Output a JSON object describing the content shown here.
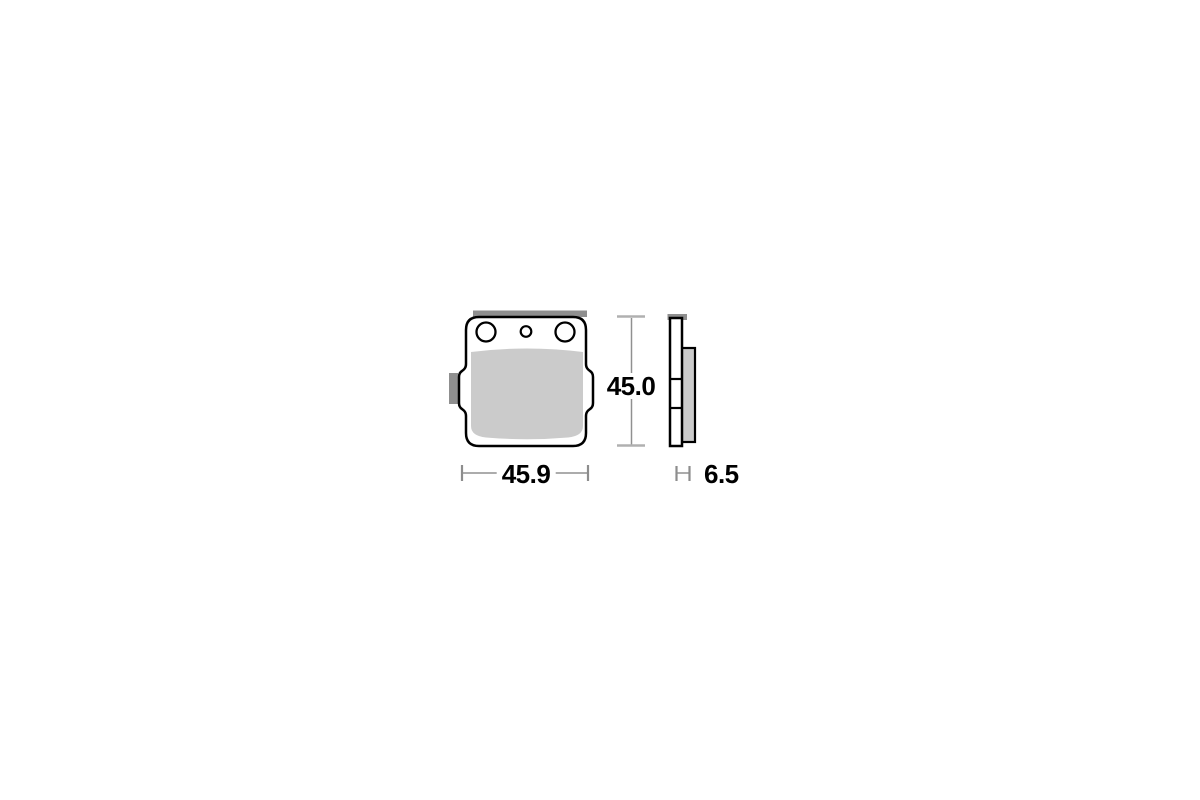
{
  "drawing": {
    "dimensions": {
      "width": "45.9",
      "height": "45.0",
      "thickness": "6.5"
    },
    "colors": {
      "background": "#ffffff",
      "friction_material": "#cbcbcb",
      "metal_tab": "#8f8f8f",
      "outline": "#000000",
      "dimension_line": "#909090",
      "dimension_cap": "#b0b0b0",
      "label_text": "#000000"
    }
  }
}
